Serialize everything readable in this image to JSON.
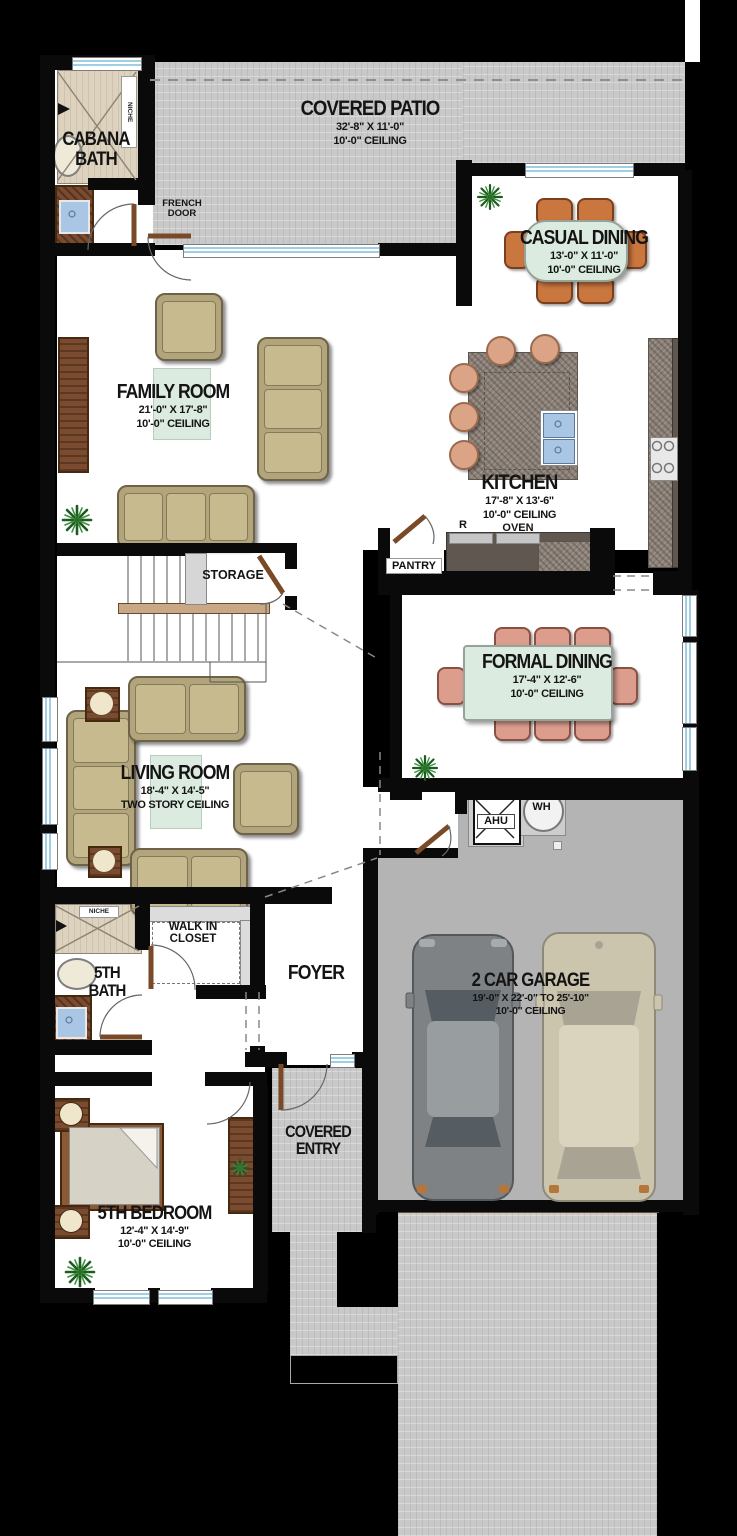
{
  "rooms": {
    "covered_patio": {
      "title": "COVERED PATIO",
      "dim": "32'-8\" X 11'-0\"",
      "ceiling": "10'-0\" CEILING"
    },
    "cabana_bath": {
      "title": "CABANA BATH"
    },
    "casual_dining": {
      "title": "CASUAL DINING",
      "dim": "13'-0\" X 11'-0\"",
      "ceiling": "10'-0\" CEILING"
    },
    "family_room": {
      "title": "FAMILY ROOM",
      "dim": "21'-0\" X 17'-8\"",
      "ceiling": "10'-0\" CEILING"
    },
    "kitchen": {
      "title": "KITCHEN",
      "dim": "17'-8\" X 13'-6\"",
      "ceiling": "10'-0\" CEILING",
      "oven": "OVEN",
      "fridge": "R"
    },
    "storage": {
      "title": "STORAGE"
    },
    "pantry": {
      "title": "PANTRY"
    },
    "formal_dining": {
      "title": "FORMAL DINING",
      "dim": "17'-4\" X 12'-6\"",
      "ceiling": "10'-0\" CEILING"
    },
    "living_room": {
      "title": "LIVING ROOM",
      "dim": "18'-4\" X 14'-5\"",
      "ceiling": "TWO STORY CEILING"
    },
    "walk_in_closet": {
      "title": "WALK IN CLOSET"
    },
    "fifth_bath": {
      "title": "5TH BATH"
    },
    "foyer": {
      "title": "FOYER"
    },
    "garage": {
      "title": "2 CAR GARAGE",
      "dim": "19'-0\" X 22'-0\" TO 25'-10\"",
      "ceiling": "10'-0\" CEILING"
    },
    "covered_entry": {
      "title": "COVERED ENTRY"
    },
    "fifth_bedroom": {
      "title": "5TH BEDROOM",
      "dim": "12'-4\" X 14'-9\"",
      "ceiling": "10'-0\" CEILING"
    }
  },
  "annotations": {
    "french_door": "FRENCH DOOR",
    "niche": "NICHE",
    "ahu": "AHU",
    "wh": "WH"
  },
  "colors": {
    "background": "#000000",
    "paver": "#c9c9c9",
    "garage_floor": "#b4b4b4",
    "label_panel": "#dcebdf",
    "sofa_tan": "#c7ba8e",
    "formal_chair": "#dd9d8d",
    "casual_chair": "#c9763f",
    "stool": "#dca487",
    "granite": "#8b8178",
    "counter_dark": "#5f5750",
    "wood": "#7a4b2e",
    "window_glass": "#9fcfe4",
    "car_gray": "#7e8285",
    "car_beige": "#ccc5ae",
    "plant_green": "#1d5c20"
  }
}
